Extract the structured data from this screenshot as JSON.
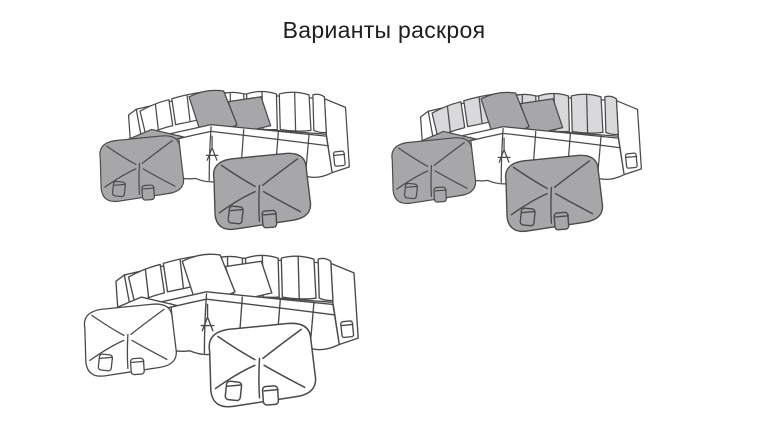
{
  "page": {
    "title": "Варианты раскроя",
    "background": "#ffffff"
  },
  "colors": {
    "outline": "#4a4a4a",
    "white": "#ffffff",
    "light_gray": "#d9d9db",
    "gray": "#a7a7a9"
  },
  "variants": [
    {
      "name": "variant-1",
      "body": "white",
      "back_cushions": "white",
      "pillows": "gray",
      "ottomans": "gray",
      "pillow_count": 2,
      "ottoman_count": 2
    },
    {
      "name": "variant-2",
      "body": "white",
      "back_cushions": "light_gray",
      "pillows": "gray",
      "ottomans": "gray",
      "pillow_count": 2,
      "ottoman_count": 2
    },
    {
      "name": "variant-3",
      "body": "white",
      "back_cushions": "white",
      "pillows": "white",
      "ottomans": "white",
      "pillow_count": 2,
      "ottoman_count": 2
    }
  ]
}
